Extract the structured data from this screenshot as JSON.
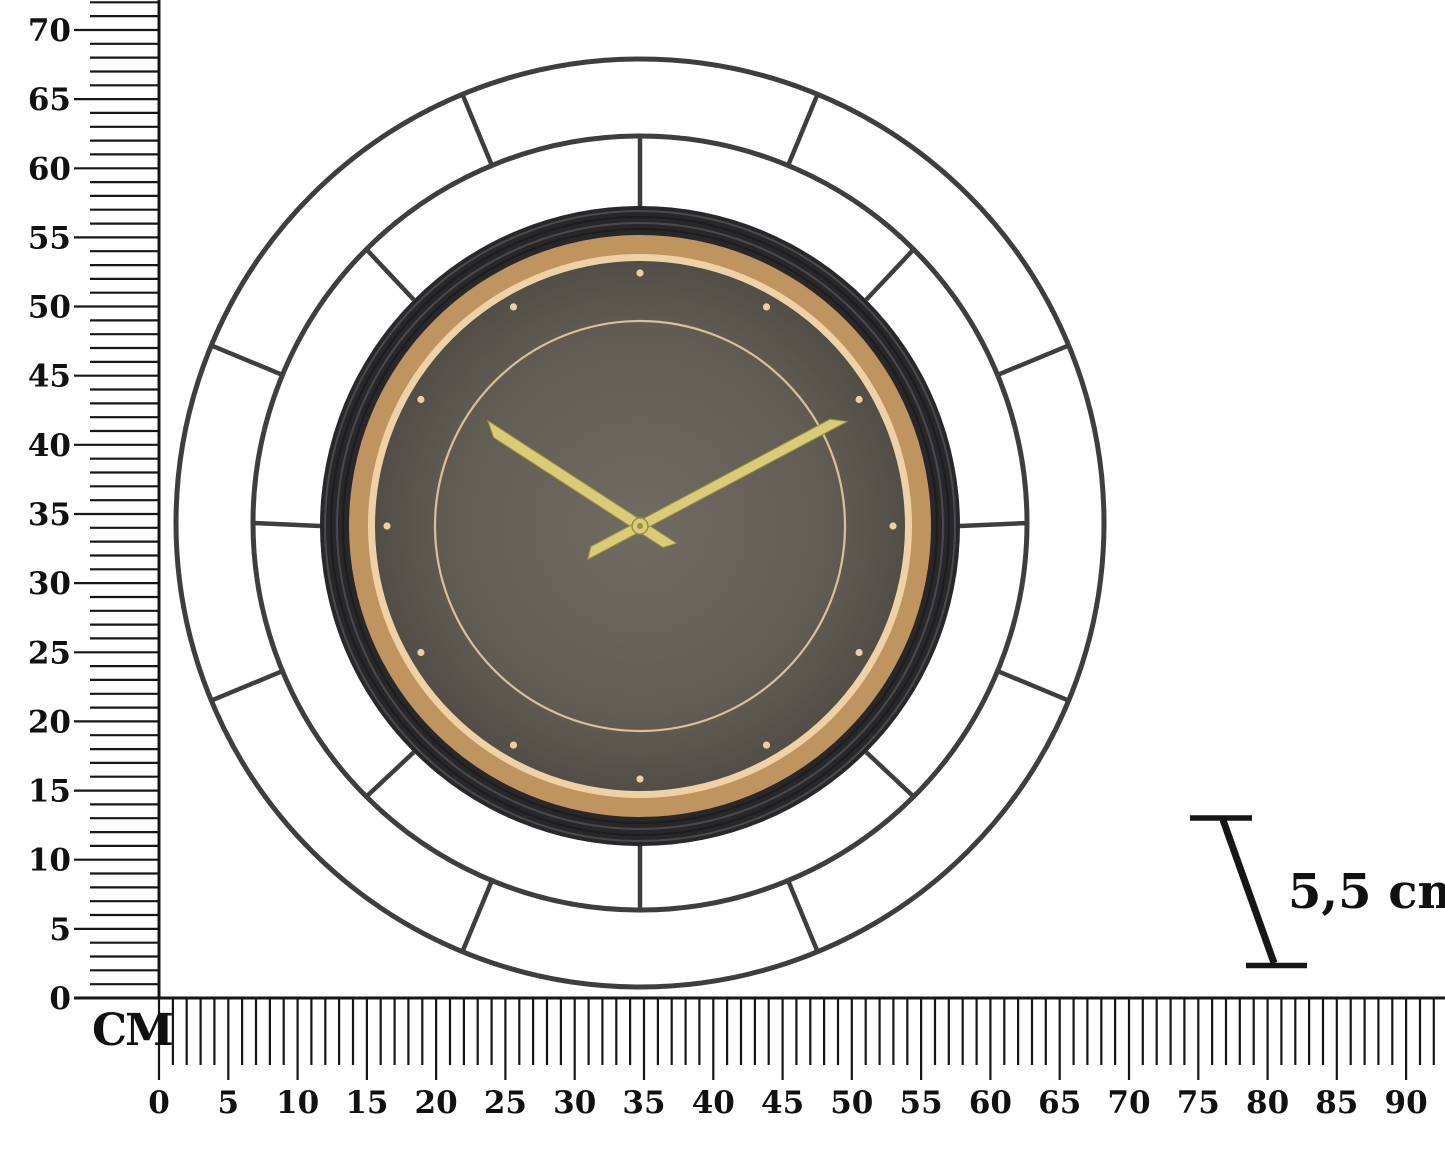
{
  "scene": {
    "background_color": "#ffffff",
    "subject": "Round metal wire-frame wall clock shown with centimeter measurement rulers"
  },
  "vertical_ruler": {
    "unit_label": "CM",
    "tick_labels": [
      "0",
      "5",
      "10",
      "15",
      "20",
      "25",
      "30",
      "35",
      "40",
      "45",
      "50",
      "55",
      "60",
      "65",
      "70"
    ],
    "label_step_cm": 5,
    "max_tick_cm": 72
  },
  "horizontal_ruler": {
    "tick_labels": [
      "0",
      "5",
      "10",
      "15",
      "20",
      "25",
      "30",
      "35",
      "40",
      "45",
      "50",
      "55",
      "60",
      "65",
      "70",
      "75",
      "80",
      "85",
      "90"
    ],
    "label_step_cm": 5,
    "max_tick_cm": 92
  },
  "depth_indicator": {
    "label": "5,5 cm"
  },
  "clock": {
    "depicted_time": "10:09",
    "hour_hand_angle_deg": 303,
    "minute_hand_angle_deg": 62,
    "hour_marker_count": 12,
    "colors": {
      "wire_frame": "#3e3e41",
      "bezel": "#28282b",
      "bezel_ridge": "#4a4a4e",
      "bezel_groove": "#1d1d20",
      "gold_ring": "#c0945f",
      "gold_ring_inner": "#eed2a6",
      "face_center": "#706c63",
      "face_mid": "#615d55",
      "face_edge": "#514e47",
      "marker_dot": "#ecd0a2",
      "minute_track": "#e9cb9c",
      "hands": "#d9cc74",
      "hands_edge": "#9c8f45"
    }
  },
  "ruler_style": {
    "line_color": "#161616",
    "text_color": "#111111"
  }
}
